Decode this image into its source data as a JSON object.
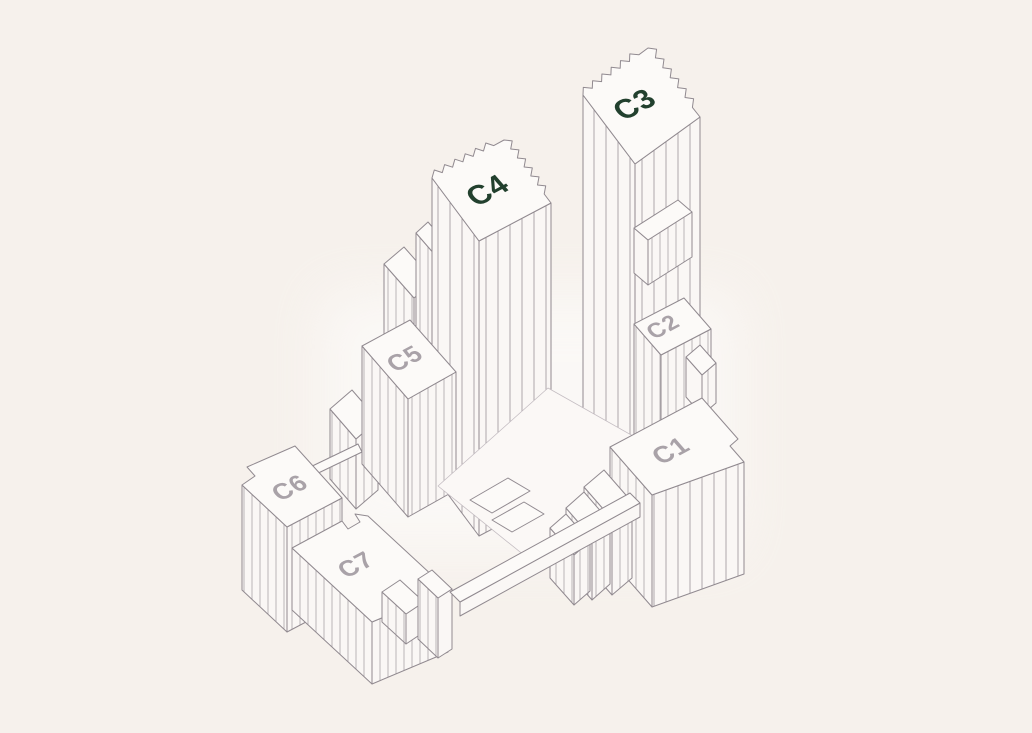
{
  "scene": {
    "type": "isometric-building-selector-map",
    "background_color": "#f6f1ec",
    "line_color": "#918a90",
    "roof_fill": "#fcfaf8",
    "facade_fill": "#faf7f5",
    "highlight_label_color": "#22402e",
    "muted_label_color": "#a9a2a8"
  },
  "buildings": [
    {
      "id": "c1",
      "label": "C1",
      "highlighted": false
    },
    {
      "id": "c2",
      "label": "C2",
      "highlighted": false
    },
    {
      "id": "c3",
      "label": "C3",
      "highlighted": true
    },
    {
      "id": "c4",
      "label": "C4",
      "highlighted": true
    },
    {
      "id": "c5",
      "label": "C5",
      "highlighted": false
    },
    {
      "id": "c6",
      "label": "C6",
      "highlighted": false
    },
    {
      "id": "c7",
      "label": "C7",
      "highlighted": false
    }
  ]
}
